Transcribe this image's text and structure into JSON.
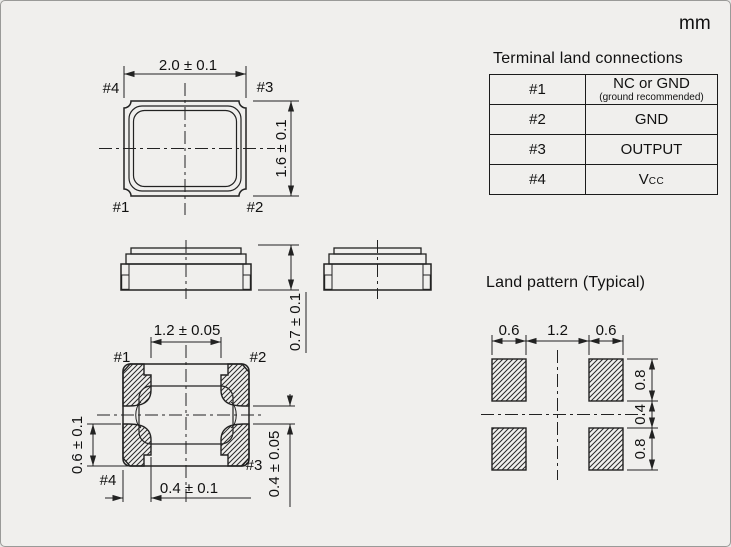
{
  "unit": "mm",
  "terminal_table": {
    "title": "Terminal land connections",
    "rows": [
      {
        "pin": "#1",
        "connection": "NC or GND",
        "note": "(ground recommended)"
      },
      {
        "pin": "#2",
        "connection": "GND"
      },
      {
        "pin": "#3",
        "connection": "OUTPUT"
      },
      {
        "pin": "#4",
        "connection": "V",
        "subscript": "CC"
      }
    ]
  },
  "top_view": {
    "width_dim": "2.0 ± 0.1",
    "height_dim": "1.6 ± 0.1",
    "pin1": "#1",
    "pin2": "#2",
    "pin3": "#3",
    "pin4": "#4"
  },
  "side_view": {
    "height_dim": "0.7 ± 0.1"
  },
  "bottom_view": {
    "top_dim": "1.2 ± 0.05",
    "left_dim": "0.6 ± 0.1",
    "bottom_dim": "0.4 ± 0.1",
    "right_dim": "0.4 ± 0.05",
    "pin1": "#1",
    "pin2": "#2",
    "pin3": "#3",
    "pin4": "#4"
  },
  "land_pattern": {
    "title": "Land pattern (Typical)",
    "pad_width_left": "0.6",
    "pad_pitch": "1.2",
    "pad_width_right": "0.6",
    "pad_height_top": "0.8",
    "pad_gap": "0.4",
    "pad_height_bottom": "0.8"
  },
  "colors": {
    "background": "#f0efed",
    "line": "#222222",
    "text": "#111111"
  }
}
